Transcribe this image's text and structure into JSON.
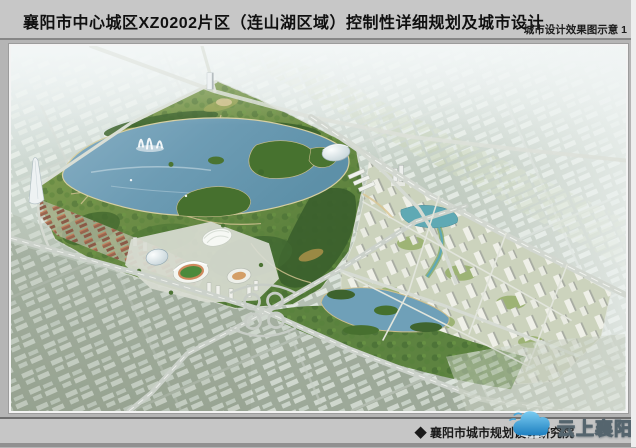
{
  "header": {
    "title": "襄阳市中心城区XZ0202片区（连山湖区域）控制性详细规划及城市设计",
    "subtitle": "城市设计效果图示意 1"
  },
  "footer": {
    "caption": "◆ 襄阳市城市规划设计研究院",
    "watermark_text": "云上襄阳"
  },
  "colors": {
    "page_background": "#b5b5b5",
    "bar_background": "#c7c7c7",
    "lake_water": "#6d9cb4",
    "park_green": "#557c38",
    "forest_green": "#3b5f2c",
    "haze_city": "#c2cdc2",
    "road_grey": "#d2d7d0",
    "residential_tower": "#f1f1ea",
    "red_roofs": "#99604a",
    "stadium_field": "#4c8a3c",
    "watermark_blue": "#1d7fc0"
  }
}
